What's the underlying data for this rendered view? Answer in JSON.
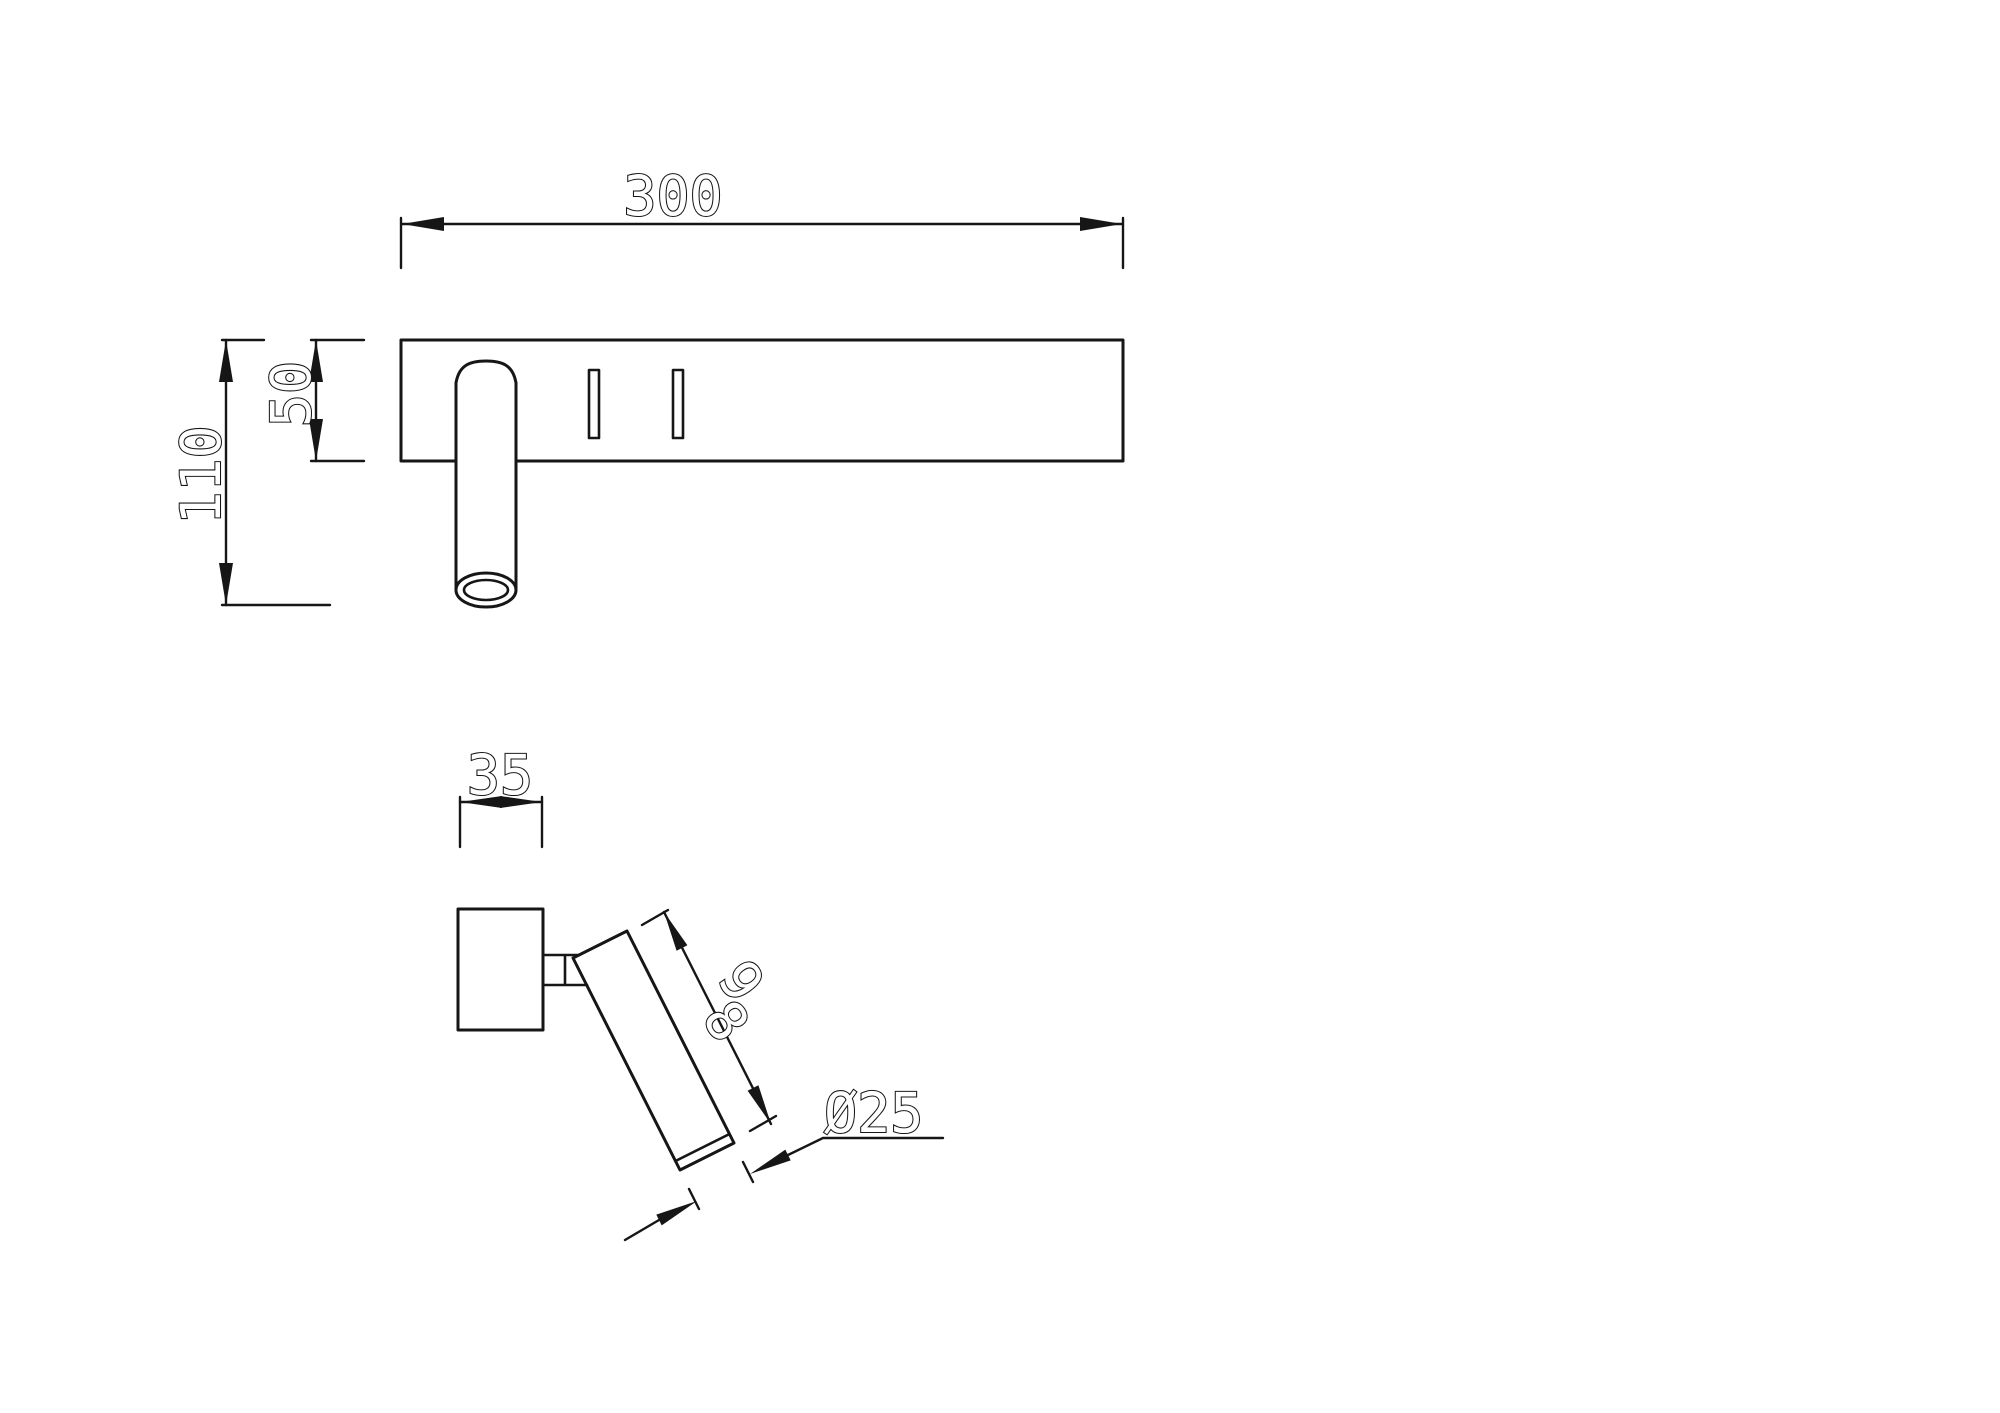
{
  "page": {
    "background": "#ffffff",
    "line_color": "#161616",
    "kind": "CAD dimensioned drawing",
    "subject": "wall-mounted spot reading light, two orthographic views"
  },
  "dimensions": {
    "plate_width": "300",
    "overall_height": "110",
    "plate_height": "50",
    "bar_depth": "35",
    "tube_length": "98",
    "tube_diameter": "Ø25"
  },
  "dimensions_mm": {
    "plate_width": 300,
    "overall_height": 110,
    "plate_height": 50,
    "bar_depth": 35,
    "tube_length": 98,
    "tube_diameter": 25
  }
}
